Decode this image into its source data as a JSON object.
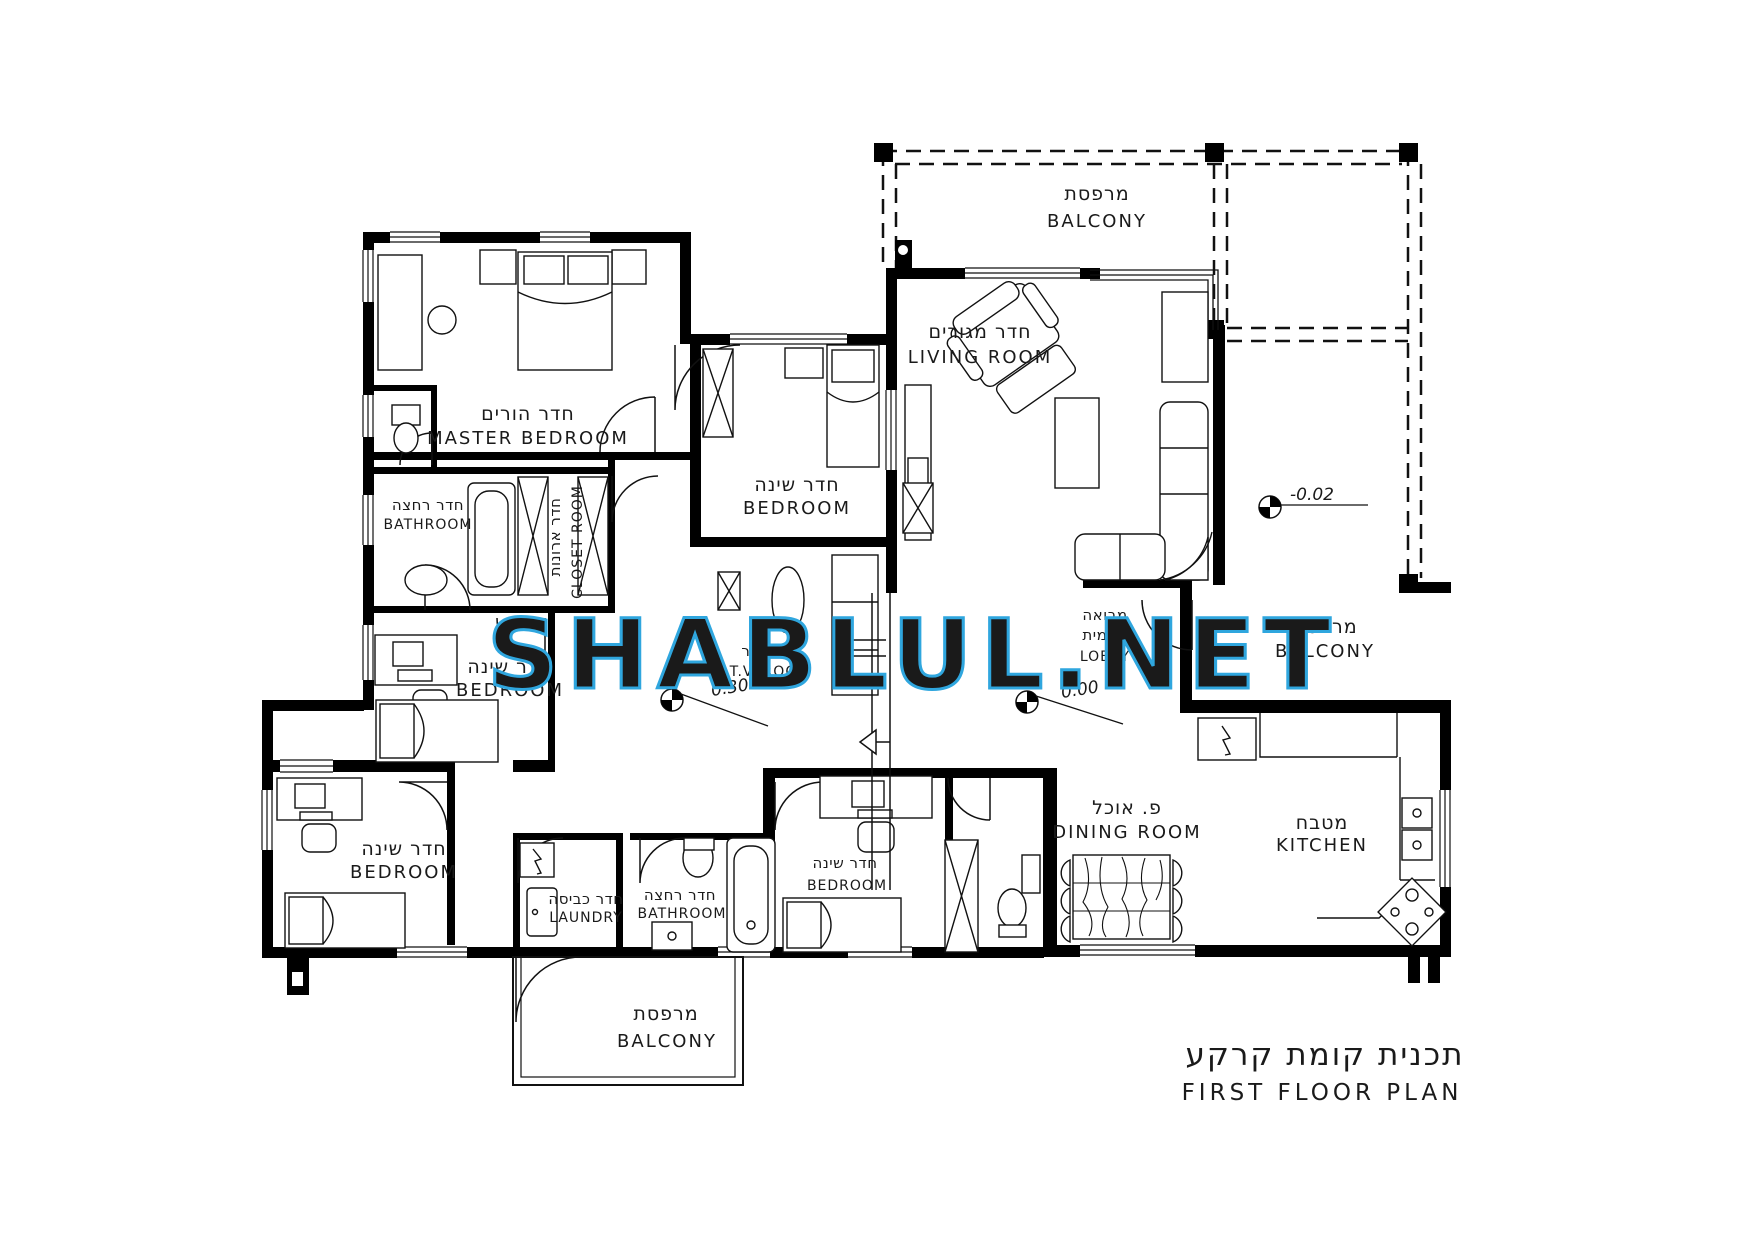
{
  "watermark": {
    "text": "SHABLUL.NET",
    "color": "#2FA6DE"
  },
  "title": {
    "he": "תכנית קומת קרקע",
    "en": "FIRST FLOOR PLAN"
  },
  "levels": {
    "living": "-0.02",
    "lobby": "0.00",
    "hall": "0.30"
  },
  "rooms": {
    "balcony_top": {
      "he": "מרפסת",
      "en": "BALCONY"
    },
    "living": {
      "he": "חדר מגורים",
      "en": "LIVING ROOM"
    },
    "master": {
      "he": "חדר הורים",
      "en": "MASTER BEDROOM"
    },
    "bath_top": {
      "he": "חדר רחצה",
      "en": "BATHROOM"
    },
    "closet": {
      "he": "חדר ארונות",
      "en": "CLOSET ROOM"
    },
    "bedroom_top": {
      "he": "חדר שינה",
      "en": "BEDROOM"
    },
    "bedroom_mid": {
      "he": "חדר שינה",
      "en": "BEDROOM"
    },
    "tv": {
      "he": "חדר T.V",
      "en": "T.V. ROOM"
    },
    "lobby": {
      "he1": "מבואה",
      "he2": "פנימית",
      "en": "LOBBY"
    },
    "balcony_right": {
      "he": "מרפסת",
      "en": "BALCONY"
    },
    "bedroom_bl": {
      "he": "חדר שינה",
      "en": "BEDROOM"
    },
    "laundry": {
      "he": "חדר כביסה",
      "en": "LAUNDRY"
    },
    "bath_bottom": {
      "he": "חדר רחצה",
      "en": "BATHROOM"
    },
    "bedroom_br": {
      "he": "חדר שינה",
      "en": "BEDROOM"
    },
    "dining": {
      "he": "פ. אוכל",
      "en": "DINING ROOM"
    },
    "kitchen": {
      "he": "מטבח",
      "en": "KITCHEN"
    },
    "balcony_bottom": {
      "he": "מרפסת",
      "en": "BALCONY"
    }
  }
}
